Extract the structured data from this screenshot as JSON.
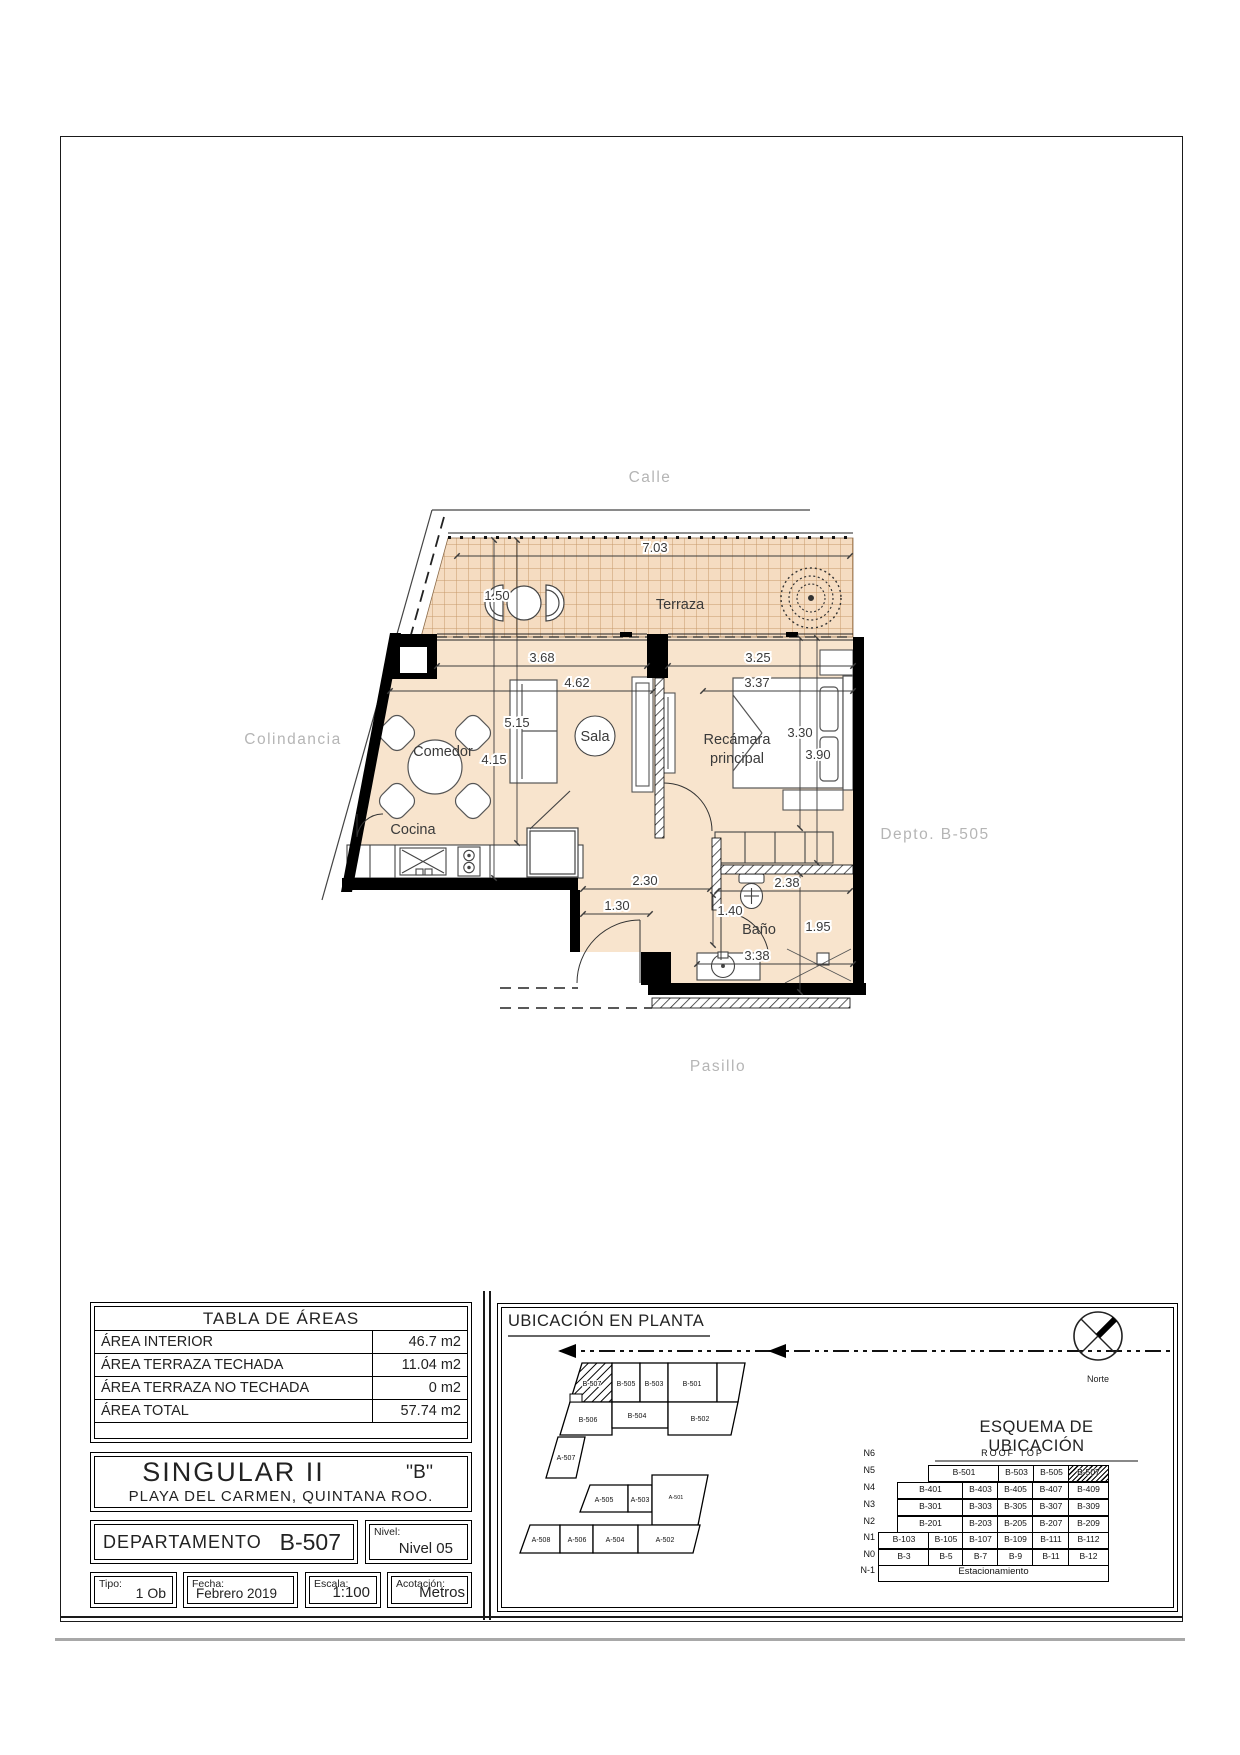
{
  "colors": {
    "floor": "#f8e4cd",
    "tile": "#f5dcc1",
    "tile_line": "#c79a6b",
    "wall": "#000000",
    "context_label": "#b5b5b5"
  },
  "plan": {
    "context": {
      "top": "Calle",
      "left": "Colindancia",
      "right": "Depto. B-505",
      "bottom": "Pasillo"
    },
    "rooms": {
      "terraza": "Terraza",
      "comedor": "Comedor",
      "cocina": "Cocina",
      "sala": "Sala",
      "recamara_line1": "Recámara",
      "recamara_line2": "principal",
      "bano": "Baño"
    },
    "dims": {
      "terraza_ancho": "7.03",
      "terraza_fondo": "1.50",
      "frente_izq": "3.68",
      "sala_ancho": "4.62",
      "fondo_1": "5.15",
      "fondo_2": "4.15",
      "recamara_frente": "3.25",
      "recamara_ancho": "3.37",
      "recamara_fondo_1": "3.30",
      "recamara_fondo_2": "3.90",
      "pasillo_1": "2.30",
      "pasillo_2": "1.30",
      "bano_ancho": "1.40",
      "bano_largo": "2.38",
      "bano_fondo": "1.95",
      "acceso": "3.38"
    }
  },
  "tabla_areas": {
    "title": "TABLA DE ÁREAS",
    "rows": [
      {
        "label": "ÁREA INTERIOR",
        "value": "46.7 m2"
      },
      {
        "label": "ÁREA TERRAZA TECHADA",
        "value": "11.04 m2"
      },
      {
        "label": "ÁREA TERRAZA NO TECHADA",
        "value": "0 m2"
      },
      {
        "label": "ÁREA TOTAL",
        "value": "57.74 m2"
      }
    ]
  },
  "title_block": {
    "project": "SINGULAR II",
    "tower": "''B''",
    "location": "PLAYA DEL CARMEN, QUINTANA ROO.",
    "departamento_label": "DEPARTAMENTO",
    "departamento_value": "B-507",
    "nivel_label": "Nivel:",
    "nivel_value": "Nivel 05",
    "tipo_label": "Tipo:",
    "tipo_value": "1 Ob",
    "fecha_label": "Fecha:",
    "fecha_value": "Febrero 2019",
    "escala_label": "Escala:",
    "escala_value": "1:100",
    "acotacion_label": "Acotación:",
    "acotacion_value": "Metros"
  },
  "ubicacion": {
    "title": "UBICACIÓN EN PLANTA",
    "units": {
      "b507": "B-507",
      "b505": "B-505",
      "b503": "B-503",
      "b501": "B-501",
      "b506": "B-506",
      "b504": "B-504",
      "b502": "B-502",
      "a507": "A-507",
      "a505": "A-505",
      "a503": "A-503",
      "a501": "A-501",
      "a508": "A-508",
      "a506": "A-506",
      "a504": "A-504",
      "a502": "A-502"
    }
  },
  "esquema": {
    "title": "ESQUEMA DE UBICACIÓN",
    "norte_label": "Norte",
    "levels": [
      "N6",
      "N5",
      "N4",
      "N3",
      "N2",
      "N1",
      "N0",
      "N-1"
    ],
    "rows": [
      [
        "ROOF TOP"
      ],
      [
        "B-501",
        "B-503",
        "B-505",
        "B-507"
      ],
      [
        "B-401",
        "B-403",
        "B-405",
        "B-407",
        "B-409"
      ],
      [
        "B-301",
        "B-303",
        "B-305",
        "B-307",
        "B-309"
      ],
      [
        "B-201",
        "B-203",
        "B-205",
        "B-207",
        "B-209"
      ],
      [
        "B-103",
        "B-105",
        "B-107",
        "B-109",
        "B-111",
        "B-112"
      ],
      [
        "B-3",
        "B-5",
        "B-7",
        "B-9",
        "B-11",
        "B-12"
      ],
      [
        "Estacionamiento"
      ]
    ]
  }
}
